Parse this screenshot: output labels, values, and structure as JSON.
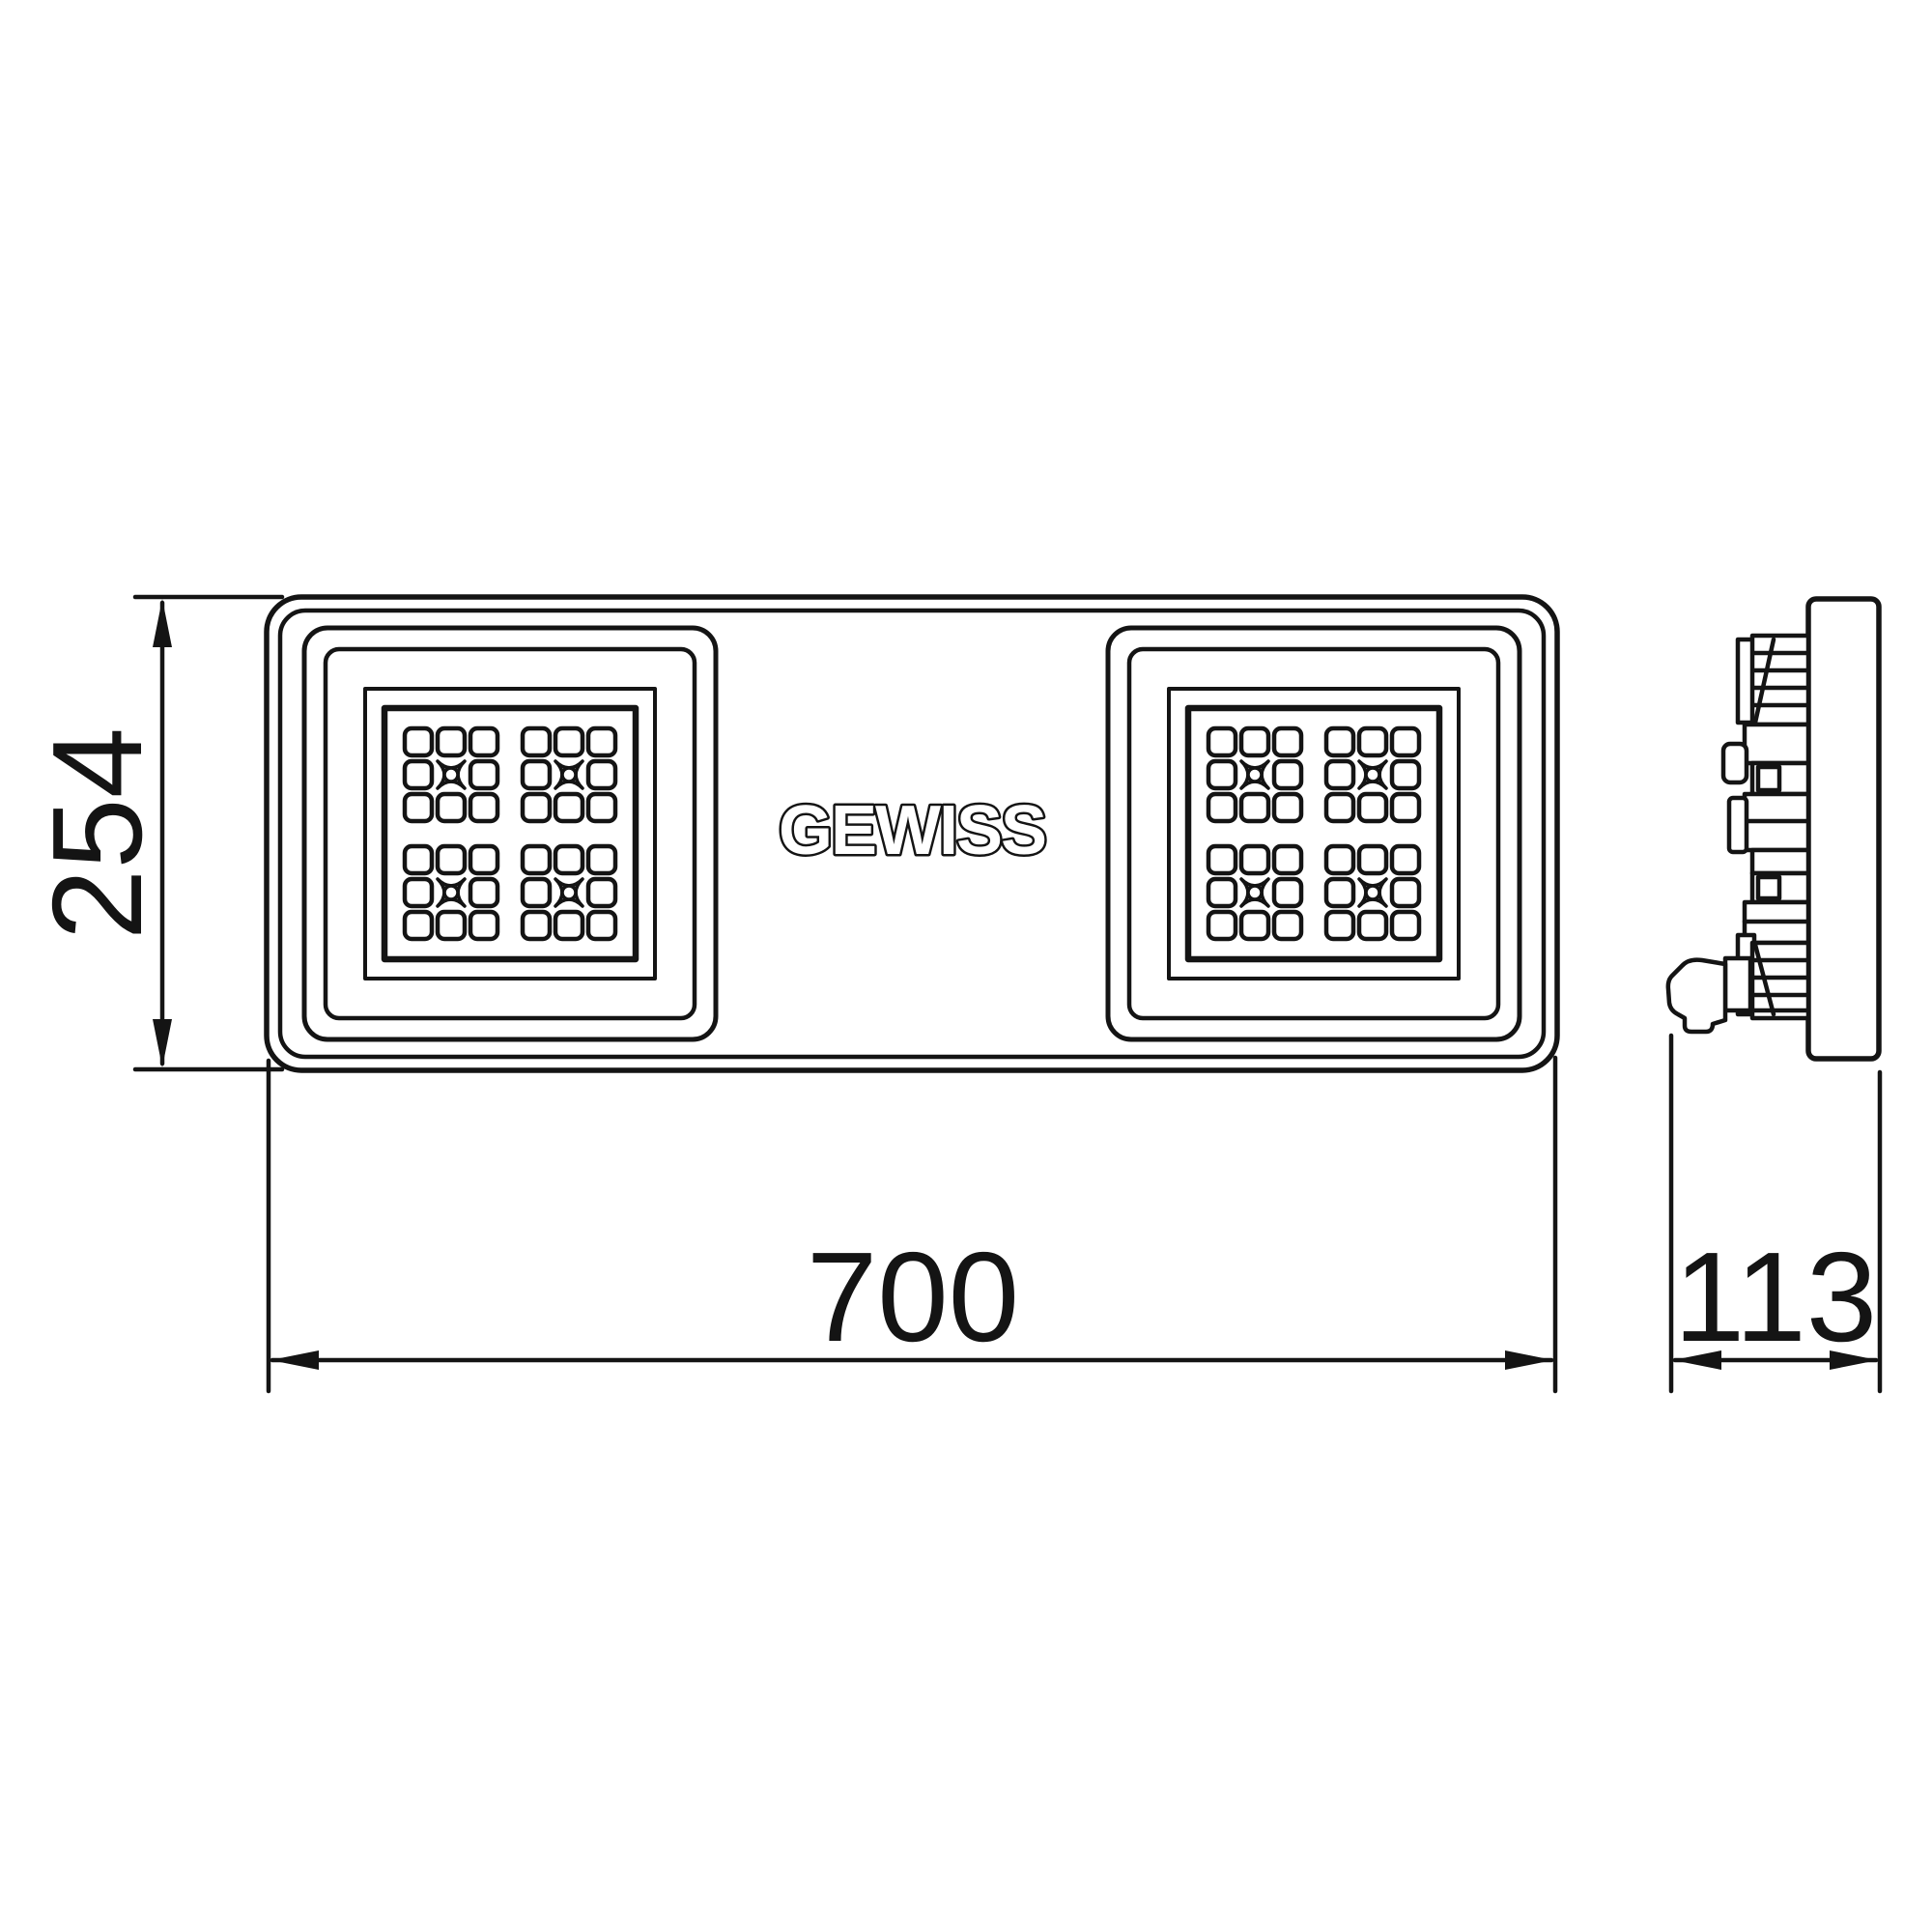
{
  "drawing": {
    "brand": "GEWISS",
    "dim_height": "254",
    "dim_width": "700",
    "dim_depth": "113"
  },
  "colors": {
    "line": "#141414",
    "background": "#ffffff"
  }
}
